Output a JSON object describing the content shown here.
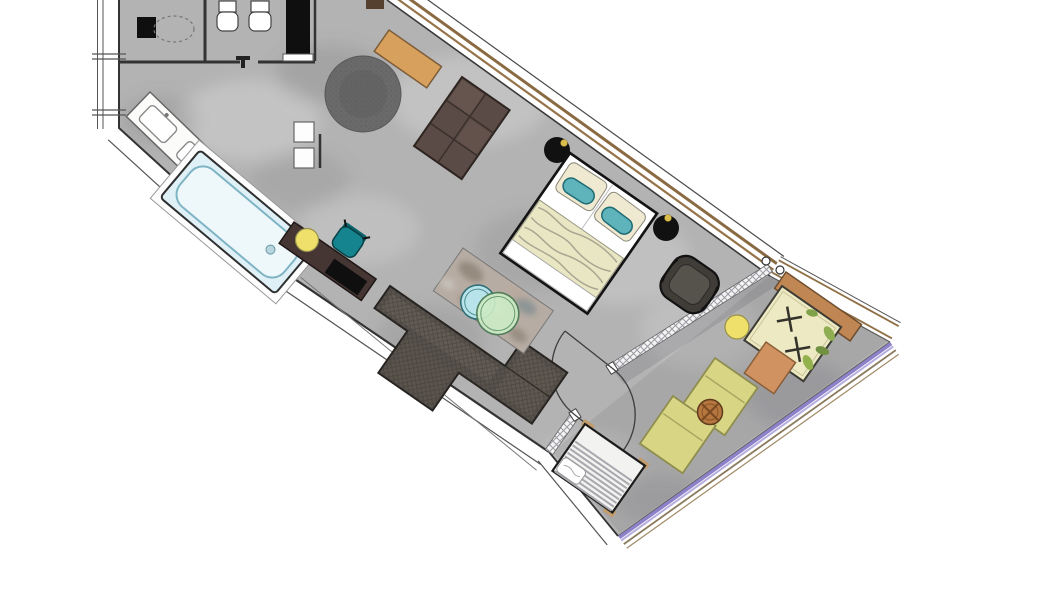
{
  "app": {
    "type": "floor-plan",
    "description": "rotated top-down plan of a hotel suite with bathroom, bedroom-living area and terrace"
  },
  "rooms": [
    "bathroom",
    "wc",
    "hallway",
    "living-bedroom",
    "terrace"
  ],
  "furniture": [
    "vanity-double-sink",
    "toilet",
    "bidet",
    "dark-cabinet",
    "wardrobe",
    "bathtub",
    "wall-shelves",
    "round-rug",
    "window-bench",
    "drawer-dresser",
    "double-bed",
    "nightstand-left",
    "nightstand-right",
    "armchair",
    "corner-sofa",
    "coffee-table",
    "sideboard",
    "desk-chair",
    "stool",
    "glass-partition",
    "double-door",
    "daybed",
    "daybed-headboard",
    "terrace-stool",
    "orange-side-table",
    "green-lounger-1",
    "green-lounger-2",
    "round-wood-table",
    "outdoor-lounger",
    "terrace-railing"
  ],
  "colors": {
    "floor": "#b3b3b3",
    "terrace_tint": "#62626c",
    "wood_frame": "#96744a",
    "bench": "#d7a05d",
    "dresser": "#5b4b46",
    "rug": "#6a6a6a",
    "bed_sheet": "#ffffff",
    "pillow": "#efe9d2",
    "bolster": "#5fb3ba",
    "blanket": "#e9e6c4",
    "nightstand": "#111111",
    "gold": "#d9bd4e",
    "armchair": "#403d39",
    "sofa": "#57524c",
    "marble": "#b7aca3",
    "circle_teal": "#b9e3ea",
    "circle_green": "#cdebc6",
    "sideboard": "#453634",
    "chair_teal": "#16848e",
    "stool_yellow": "#eee06b",
    "bathtub": "#dff0f6",
    "vanity": "#fbfbf9",
    "daybed": "#ede9c2",
    "daybed_wood": "#c08653",
    "lounger_green": "#d8d685",
    "table_wood": "#b5763f",
    "table_orange": "#cf9260",
    "railing_purple": "#8d81c9",
    "railing_purple_light": "#b7aede",
    "lounger_white": "#f2f2f0",
    "black": "#0f0f0f"
  }
}
